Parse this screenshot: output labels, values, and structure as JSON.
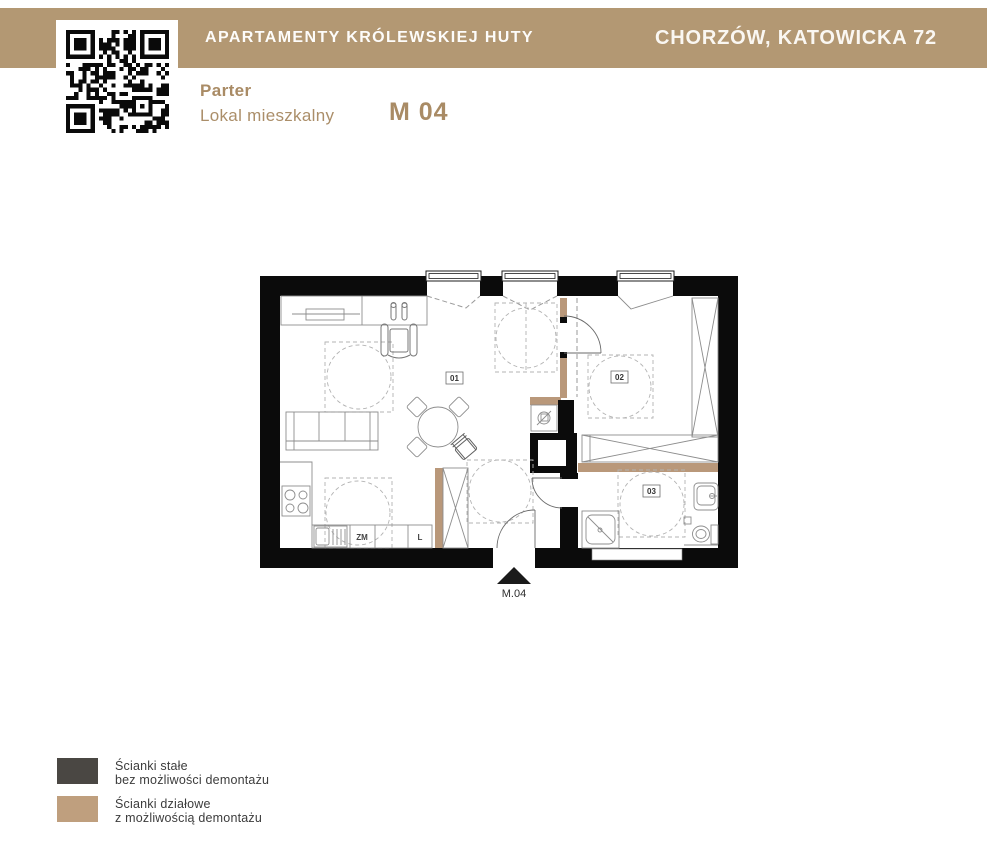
{
  "header": {
    "title": "APARTAMENTY KRÓLEWSKIEJ HUTY",
    "location": "CHORZÓW, KATOWICKA 72"
  },
  "unit": {
    "floor": "Parter",
    "type_label": "Lokal mieszkalny",
    "number": "M 04"
  },
  "floor_plan": {
    "room_labels": [
      "01",
      "02",
      "03"
    ],
    "appliance_labels": {
      "zm": "ZM",
      "l": "L"
    },
    "entrance_label": "M.04"
  },
  "legend": {
    "items": [
      {
        "swatch_color": "#4a4743",
        "line1": "Ścianki stałe",
        "line2": "bez możliwości demontażu"
      },
      {
        "swatch_color": "#bf9f7e",
        "line1": "Ścianki działowe",
        "line2": "z możliwością demontażu"
      }
    ]
  },
  "colors": {
    "header_bar": "#b39873",
    "accent_text": "#a98b65",
    "wall": "#0b0b0b",
    "partition": "#b9987a"
  }
}
